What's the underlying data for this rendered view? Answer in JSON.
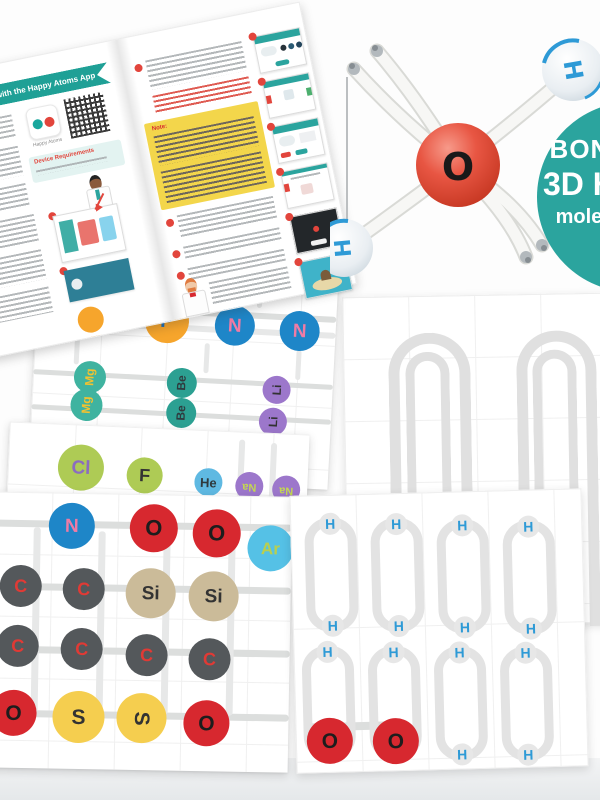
{
  "booklet": {
    "banner_title": "with the Happy Atoms App",
    "app_name": "Happy Atoms",
    "device_requirements_heading": "Device Requirements",
    "note_heading": "Note:"
  },
  "bonus_badge": {
    "line1": "BONUS",
    "line2": "3D H₂O",
    "line3": "molecule",
    "background": "#2BA49E"
  },
  "molecule_model": {
    "center_atom": "O",
    "hydrogen_top": "H",
    "hydrogen_bottom": "H"
  },
  "puzzle_sheets": {
    "pn_sheet": {
      "row1": [
        "P",
        "P",
        "N",
        "N"
      ],
      "row2": [
        "Mg",
        "Mg",
        "Be",
        "Be",
        "Li",
        "Li"
      ]
    },
    "halogen_strip": [
      "Cl",
      "F",
      "He",
      "Na",
      "Na"
    ],
    "carbon_sheet": {
      "row1": [
        "N",
        "O",
        "O",
        "Ar"
      ],
      "row2": [
        "C",
        "C",
        "Si",
        "Si"
      ],
      "row3": [
        "C",
        "C",
        "C",
        "C"
      ],
      "row4": [
        "O",
        "S",
        "S",
        "O"
      ]
    },
    "hydrogen_sheet": {
      "hydrogen": "H",
      "oxygen": "O"
    }
  },
  "colors": {
    "teal_accent": "#2BA49E",
    "red_accent": "#E2453C",
    "track_gray": "#dcdedd",
    "element_colors": {
      "P": "#F6A52C",
      "N": "#1E86C8",
      "Mg": "#3FB3A0",
      "Be": "#2CA092",
      "Li": "#9C77CB",
      "Cl": "#AECB55",
      "F": "#AECB55",
      "He": "#5FB9E2",
      "Na": "#9C77CB",
      "O": "#D7282F",
      "Ar": "#55C1E6",
      "C": "#54585B",
      "Si": "#CBBB99",
      "S": "#F5CE4F",
      "H": "#2E9AD6"
    }
  }
}
